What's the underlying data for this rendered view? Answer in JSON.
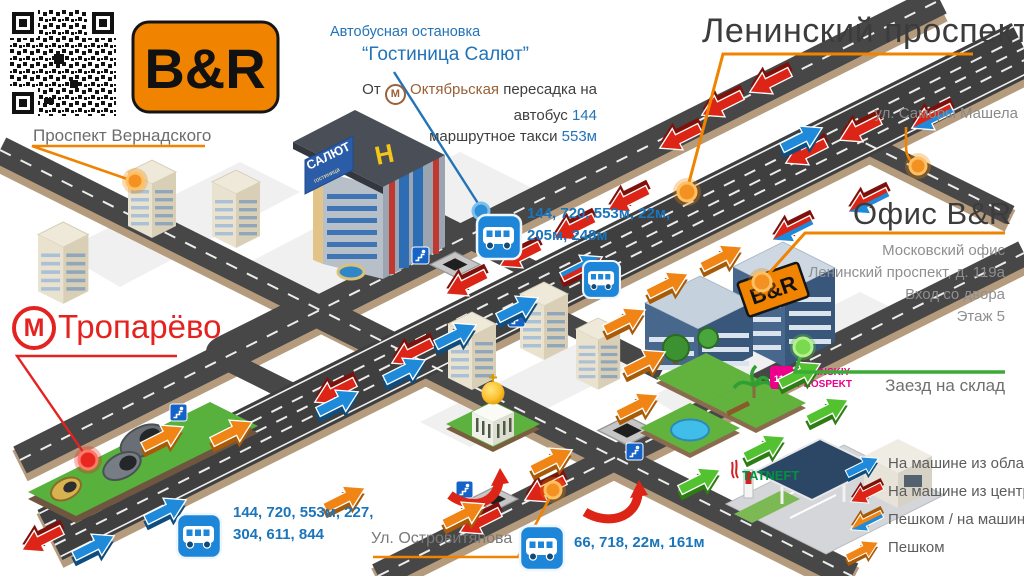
{
  "branding": {
    "logo": "B&R"
  },
  "streets": {
    "vernadskogo": "Проспект Вернадского",
    "leninsky": "Ленинский проспект",
    "samory": "ул. Саморы Машела",
    "ostrovityanova": "Ул. Островитянова"
  },
  "metro": {
    "troparevo": "Тропарёво",
    "m": "М"
  },
  "bus_stop": {
    "caption": "Автобусная остановка",
    "name": "“Гостиница Салют”"
  },
  "transfer": {
    "from": "От",
    "m": "М",
    "station": "Октябрьская",
    "rest": "пересадка на",
    "bus_word": "автобус",
    "bus_num": "144",
    "taxi_word": "маршрутное такси",
    "taxi_num": "553м"
  },
  "office": {
    "title": "Офис B&R",
    "sign": "B&R",
    "lines": [
      "Московский офис",
      "Ленинский проспект, д. 119а",
      "Вход со двора",
      "Этаж 5"
    ]
  },
  "warehouse": {
    "label": "Заезд на склад"
  },
  "routes": {
    "salut_line1": "144, 720, 553м, 22м,",
    "salut_line2": "205м, 248м",
    "sw_line1": "144, 720, 553м, 227,",
    "sw_line2": "304, 611, 844",
    "south_line1": "66, 718, 22м, 161м"
  },
  "legend": {
    "items": [
      {
        "label": "На машине из области"
      },
      {
        "label": "На машине из центра"
      },
      {
        "label": "Пешком / на машине"
      },
      {
        "label": "Пешком"
      }
    ]
  },
  "map_signs": {
    "leninskiy1": "LENINSKIY",
    "leninskiy2": "PROSPEKT",
    "leninskiy_num": "119",
    "tatneft": "TATNEFT",
    "salut": "САЛЮТ",
    "salut_sub": "гостиница",
    "helipad": "H"
  }
}
